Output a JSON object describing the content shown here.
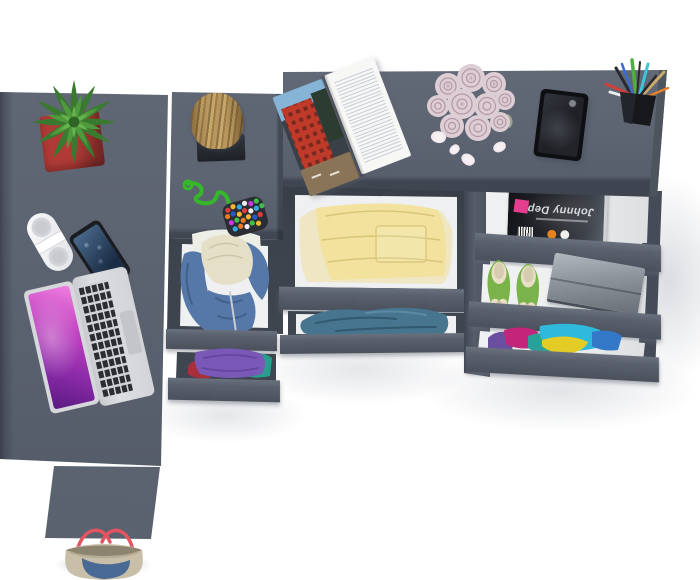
{
  "scene": {
    "type": "3d-product-render",
    "subject": "Top-down view of an anthracite gray L-shaped desk and drawer cabinet with open drawers full of clothes and accessories",
    "background": "#ffffff"
  },
  "text": {
    "drawer_magazine_title": "Johnny Depp"
  },
  "items": [
    {
      "name": "cactus-plant",
      "label": "green succulent in red square pot"
    },
    {
      "name": "white-speaker",
      "label": "white portable speaker remote"
    },
    {
      "name": "smartphone",
      "label": "black smartphone"
    },
    {
      "name": "laptop",
      "label": "silver laptop with pink screen"
    },
    {
      "name": "wood-stump",
      "label": "wooden stump decor on dark stand"
    },
    {
      "name": "pompom-keychain",
      "label": "green cord keychain with multicolor pompom pouch"
    },
    {
      "name": "open-magazine",
      "label": "open magazine with red building photo"
    },
    {
      "name": "rose-bouquet",
      "label": "pale pink roses with fallen petals"
    },
    {
      "name": "picture-frame",
      "label": "dark picture frame"
    },
    {
      "name": "pencil-cup",
      "label": "black cup with pens and pencils"
    },
    {
      "name": "celebrity-magazine",
      "label": "black magazine lying upside down in drawer"
    },
    {
      "name": "green-flats",
      "label": "green ballet flats with cream bows"
    },
    {
      "name": "gray-case",
      "label": "gray metal case"
    },
    {
      "name": "yellow-clothes",
      "label": "folded pale yellow clothes"
    },
    {
      "name": "blue-jeans",
      "label": "folded teal-blue jeans"
    },
    {
      "name": "blue-hoodie",
      "label": "denim hoodie with cream lining over white shirt"
    },
    {
      "name": "purple-clothes",
      "label": "folded purple, teal and red clothes"
    },
    {
      "name": "colorful-clothes",
      "label": "pile of cyan, yellow, magenta and purple clothes"
    },
    {
      "name": "tote-bag",
      "label": "beige and denim tote bag with red handles"
    }
  ],
  "colors": {
    "background": "#ffffff",
    "desk_top": "#5d6472",
    "desk_top_dark": "#555c6a",
    "desk_edge": "#454c58",
    "front_light": "#6a717e",
    "front_dark": "#4a515d",
    "cavity": "#3d434d",
    "cavity_dark": "#262b33",
    "divider": "#565d69",
    "interior": "#eef0f1",
    "leg": "#646c7a",
    "pot_light": "#b03a36",
    "pot_dark": "#7e2a27",
    "cactus_dark": "#3a7a30",
    "cactus_mid": "#4f9a3c",
    "cactus_light": "#67b44e",
    "stump_light": "#c6a76c",
    "stump_dark": "#9d7c46",
    "stand": "#1e2228",
    "speaker_grille": "#c9cacf",
    "phone_body": "#1a1c20",
    "phone_screen_light": "#4a6a8c",
    "phone_screen_dark": "#1a2c44",
    "laptop_silver": "#d5d7db",
    "laptop_key": "#2b2d31",
    "laptop_trackpad": "#c3c5c9",
    "laptop_screen_a": "#f080e0",
    "laptop_screen_b": "#5a1a80",
    "cord_green": "#35b82a",
    "pouch": "#2a2d33",
    "dot_1": "#e03c3c",
    "dot_2": "#f5b82e",
    "dot_3": "#35a8e0",
    "dot_4": "#c43ce0",
    "dot_5": "#3cc048",
    "dot_6": "#f07820",
    "dot_7": "#f0f0f0",
    "dot_8": "#2858c8",
    "page_white": "#f7f7f5",
    "photo_bg": "#3a4048",
    "photo_red": "#c03a2a",
    "photo_sky": "#86b4d6",
    "rose": "#ddcdd4",
    "rose_line": "#b398a4",
    "petal": "#ecdfe5",
    "frame": "#0e0f12",
    "frame_inner": "#1f2126",
    "cup": "#16181c",
    "jd_dark": "#121317",
    "jd_light": "#585e66",
    "jd_title": "#d6dade",
    "jd_pink": "#e63e8e",
    "shoe_green": "#79b34a",
    "shoe_cream": "#e8dfc6",
    "box_light": "#b2b8be",
    "box_dark": "#686e76",
    "pile_cyan": "#2fb9dd",
    "pile_yellow": "#e3cc25",
    "pile_magenta": "#c2257a",
    "pile_purple": "#6a4fa0",
    "pile_blue": "#3478c8",
    "pile_teal": "#2aa198",
    "cloth_yellow": "#f2e29e",
    "cloth_cream": "#efe6c4",
    "jeans": "#47748e",
    "jeans_dark": "#32596f",
    "hoodie": "#5578a8",
    "hoodie_dark": "#41608a",
    "hood_cream": "#e6dfc8",
    "shirt_white": "#edeee6",
    "purple_cloth": "#7a58b8",
    "teal_cloth": "#2a9e8e",
    "red_cloth": "#a8303c",
    "bag_beige": "#c9bfa8",
    "bag_denim": "#4a6a96",
    "bag_handle": "#e25560"
  }
}
